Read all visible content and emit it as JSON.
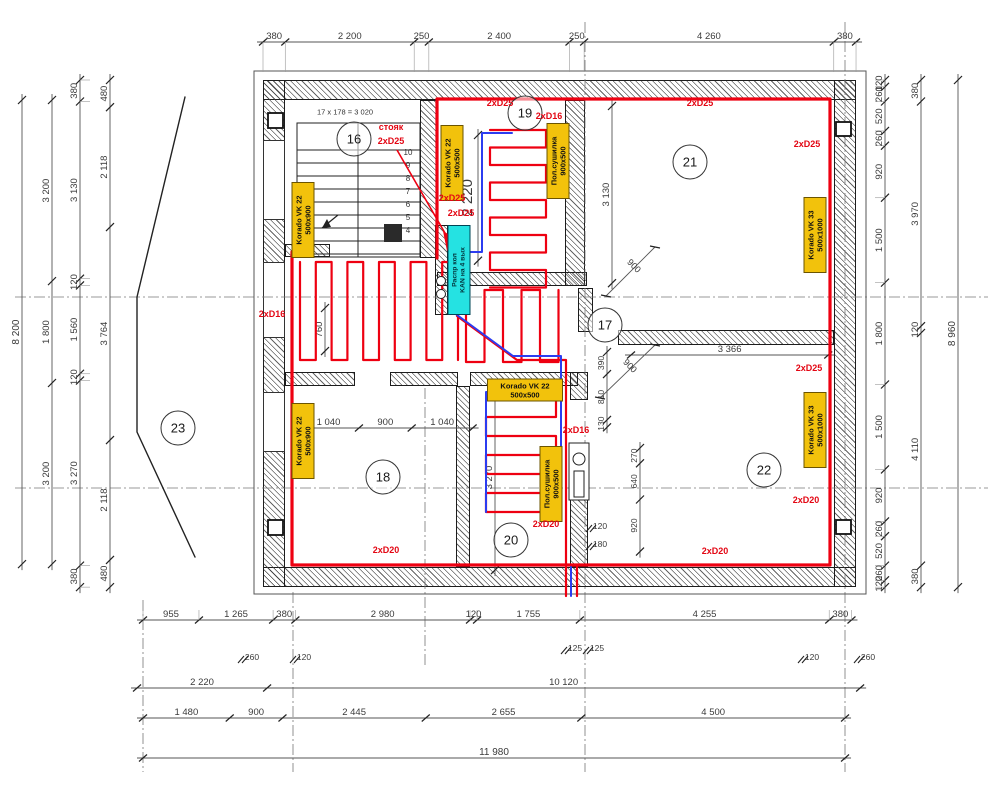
{
  "drawing": {
    "stair_note": "17 x 178 = 3 020",
    "stair_steps": [
      "10",
      "9",
      "8",
      "7",
      "6",
      "5",
      "4"
    ],
    "colors": {
      "pipe_red": "#ee0011",
      "pipe_blue": "#2b3cf0",
      "radiator_yellow": "#f2c20c",
      "manifold_cyan": "#25e2e2",
      "label_red": "#e30613",
      "wall_line": "#1c1c1c",
      "dim_text": "#3a3a3a"
    },
    "rooms": [
      {
        "n": "16",
        "x": 354,
        "y": 139
      },
      {
        "n": "17",
        "x": 605,
        "y": 325
      },
      {
        "n": "18",
        "x": 383,
        "y": 477
      },
      {
        "n": "19",
        "x": 525,
        "y": 113
      },
      {
        "n": "20",
        "x": 511,
        "y": 540
      },
      {
        "n": "21",
        "x": 690,
        "y": 162
      },
      {
        "n": "22",
        "x": 764,
        "y": 470
      },
      {
        "n": "23",
        "x": 178,
        "y": 428
      }
    ],
    "radiators": [
      {
        "name": "Korado VK 22",
        "size": "500x900",
        "x": 303,
        "y": 220,
        "vert": true
      },
      {
        "name": "Korado VK 22",
        "size": "500x900",
        "x": 303,
        "y": 441,
        "vert": true
      },
      {
        "name": "Korado VK 22",
        "size": "500x500",
        "x": 452,
        "y": 163,
        "vert": true
      },
      {
        "name": "Пол.сушилка",
        "size": "900x500",
        "x": 558,
        "y": 161,
        "vert": true
      },
      {
        "name": "Korado VK 33",
        "size": "500x1000",
        "x": 815,
        "y": 235,
        "vert": true
      },
      {
        "name": "Korado VK 33",
        "size": "500x1000",
        "x": 815,
        "y": 430,
        "vert": true
      },
      {
        "name": "Korado VK 22",
        "size": "500x500",
        "x": 525,
        "y": 390,
        "vert": false
      },
      {
        "name": "Пол.сушилка",
        "size": "900x500",
        "x": 551,
        "y": 484,
        "vert": true
      }
    ],
    "manifold": {
      "line1": "Распр кол",
      "line2": "KAN на 4 вых",
      "x": 459,
      "y": 270
    },
    "pipe_labels": [
      {
        "t": "стояк",
        "x": 391,
        "y": 127
      },
      {
        "t": "2xD25",
        "x": 391,
        "y": 141
      },
      {
        "t": "2xD25",
        "x": 452,
        "y": 198
      },
      {
        "t": "2xD25",
        "x": 461,
        "y": 213
      },
      {
        "t": "2xD25",
        "x": 500,
        "y": 103
      },
      {
        "t": "2xD16",
        "x": 549,
        "y": 116
      },
      {
        "t": "2xD25",
        "x": 700,
        "y": 103
      },
      {
        "t": "2xD25",
        "x": 807,
        "y": 144
      },
      {
        "t": "2xD16",
        "x": 272,
        "y": 314
      },
      {
        "t": "2xD25",
        "x": 809,
        "y": 368
      },
      {
        "t": "2xD16",
        "x": 576,
        "y": 430
      },
      {
        "t": "2xD20",
        "x": 386,
        "y": 550
      },
      {
        "t": "2xD20",
        "x": 546,
        "y": 524
      },
      {
        "t": "2xD20",
        "x": 806,
        "y": 500
      },
      {
        "t": "2xD20",
        "x": 715,
        "y": 551
      }
    ],
    "dim_chains": [
      {
        "id": "top",
        "dir": "h",
        "x": 263,
        "y": 42,
        "ext": "down",
        "extLen": 30,
        "labels": [
          "380",
          "2 200",
          "250",
          "2 400",
          "250",
          "4 260",
          "380"
        ]
      },
      {
        "id": "bottom-1",
        "dir": "h",
        "x": 143,
        "y": 620,
        "ext": "up",
        "extLen": 10,
        "labels": [
          "955",
          "1 265",
          "380",
          "2 980",
          "120",
          "1 755",
          "4 255",
          "380"
        ]
      },
      {
        "id": "bottom-2",
        "dir": "h",
        "x": 137,
        "y": 688,
        "labels": [
          "2 220",
          "10 120"
        ]
      },
      {
        "id": "bottom-3",
        "dir": "h",
        "x": 143,
        "y": 718,
        "labels": [
          "1 480",
          "900",
          "2 445",
          "2 655",
          "4 500"
        ]
      },
      {
        "id": "bottom-4",
        "dir": "h",
        "x": 143,
        "y": 758,
        "fs": 10,
        "labels": [
          "11 980"
        ]
      },
      {
        "id": "left-1",
        "dir": "v",
        "x": 22,
        "y": 100,
        "fs": 10,
        "labels": [
          "8 200"
        ]
      },
      {
        "id": "left-2",
        "dir": "v",
        "x": 52,
        "y": 100,
        "labels": [
          "3 200",
          "1 800",
          "3 200"
        ]
      },
      {
        "id": "left-3",
        "dir": "v",
        "x": 80,
        "y": 80,
        "ext": "right",
        "extLen": 10,
        "labels": [
          "380",
          "3 130",
          "120",
          "1 560",
          "120",
          "3 270",
          "380"
        ]
      },
      {
        "id": "left-4",
        "dir": "v",
        "x": 110,
        "y": 80,
        "labels": [
          "480",
          "2 118",
          "3 764",
          "2 118",
          "480"
        ]
      },
      {
        "id": "right-1",
        "dir": "v",
        "x": 885,
        "y": 80,
        "ext": "left",
        "extLen": 10,
        "labels": [
          "120",
          "260",
          "520",
          "260",
          "920",
          "1 500",
          "1 800",
          "1 500",
          "920",
          "260",
          "520",
          "260",
          "120"
        ]
      },
      {
        "id": "right-2",
        "dir": "v",
        "x": 921,
        "y": 80,
        "labels": [
          "380",
          "3 970",
          "120",
          "4 110",
          "380"
        ]
      },
      {
        "id": "right-3",
        "dir": "v",
        "x": 958,
        "y": 80,
        "fs": 10,
        "labels": [
          "8 960"
        ]
      },
      {
        "id": "int-3130",
        "dir": "v",
        "x": 612,
        "y": 106,
        "labels": [
          "3 130"
        ]
      },
      {
        "id": "int-room18",
        "dir": "h",
        "x": 298,
        "y": 428,
        "labels": [
          "1 040",
          "900",
          "1 040"
        ]
      },
      {
        "id": "int-760",
        "dir": "v",
        "x": 325,
        "y": 308,
        "labels": [
          "760"
        ]
      },
      {
        "id": "int-3270",
        "dir": "v",
        "x": 495,
        "y": 385,
        "labels": [
          "3 270"
        ]
      },
      {
        "id": "int-3366",
        "dir": "h",
        "x": 631,
        "y": 355,
        "labels": [
          "3 366"
        ]
      },
      {
        "id": "int-mid-a",
        "dir": "v",
        "x": 607,
        "y": 352,
        "fs": 8.5,
        "labels": [
          "390",
          "810",
          "130"
        ]
      },
      {
        "id": "int-mid-b",
        "dir": "v",
        "x": 640,
        "y": 448,
        "fs": 8.5,
        "labels": [
          "270",
          "640",
          "920"
        ]
      },
      {
        "id": "int-2220",
        "dir": "v",
        "x": 478,
        "y": 135,
        "fs": 15,
        "labels": [
          "2 220"
        ]
      }
    ],
    "free_dims": [
      {
        "t": "260",
        "x": 252,
        "y": 660
      },
      {
        "t": "120",
        "x": 304,
        "y": 660
      },
      {
        "t": "125",
        "x": 575,
        "y": 651
      },
      {
        "t": "125",
        "x": 597,
        "y": 651
      },
      {
        "t": "120",
        "x": 812,
        "y": 660
      },
      {
        "t": "260",
        "x": 868,
        "y": 660
      },
      {
        "t": "120",
        "x": 600,
        "y": 529
      },
      {
        "t": "180",
        "x": 600,
        "y": 547
      }
    ],
    "diag_dims": [
      {
        "t": "900",
        "x1": 655,
        "y1": 345,
        "x2": 600,
        "y2": 398,
        "tx": 628,
        "ty": 368
      },
      {
        "t": "900",
        "x1": 655,
        "y1": 247,
        "x2": 606,
        "y2": 296,
        "tx": 632,
        "ty": 268
      }
    ]
  }
}
